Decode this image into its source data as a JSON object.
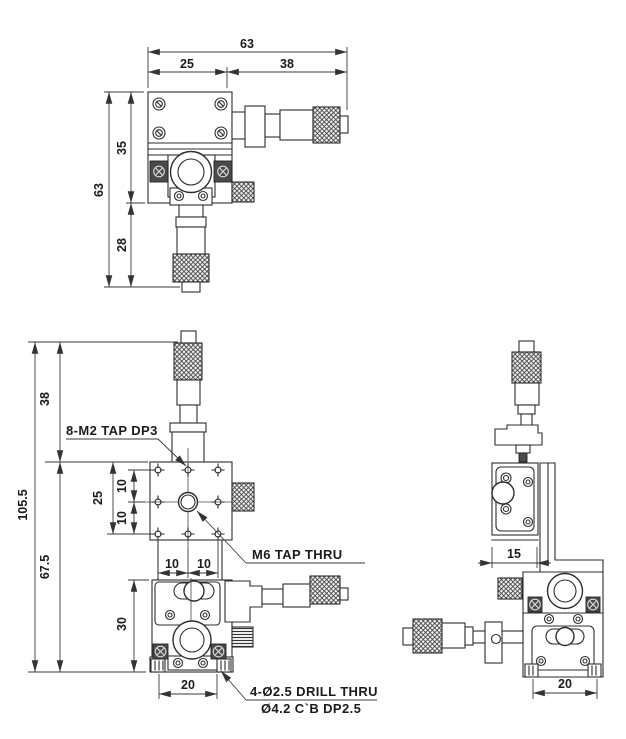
{
  "drawing": {
    "background": "#ffffff",
    "line_color": "#2d2d2d",
    "dark_fill": "#4a4a4a",
    "top_view": {
      "dims": {
        "total_width": "63",
        "width_left": "25",
        "width_right": "38",
        "total_depth": "63",
        "depth_upper": "35",
        "depth_lower": "28"
      }
    },
    "front_view": {
      "dims": {
        "mic_clearance": "38",
        "total_height": "105.5",
        "body_height": "67.5",
        "hole_span": "25",
        "hole_pitch_v_upper": "10",
        "hole_pitch_v_lower": "10",
        "hole_pitch_h_left": "10",
        "hole_pitch_h_right": "10",
        "lower_stage_height": "30",
        "base_width": "20"
      },
      "notes": {
        "tap_m2": "8-M2 TAP DP3",
        "tap_m6": "M6 TAP THRU",
        "drill_thru": "4-Ø2.5 DRILL THRU",
        "counterbore": "Ø4.2 C`B DP2.5"
      }
    },
    "side_view": {
      "dims": {
        "upper_body_width": "15",
        "base_width": "20"
      }
    }
  }
}
